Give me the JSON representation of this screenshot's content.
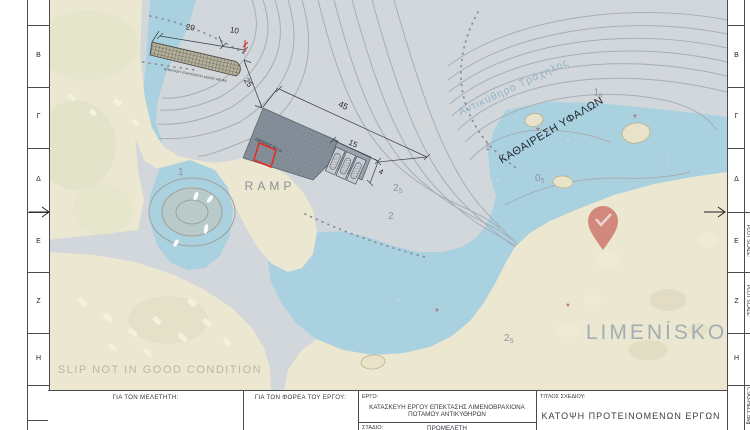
{
  "colors": {
    "sea": "#d2d7dc",
    "shallow_water": "#a9d1e0",
    "land": "#ebe7d0",
    "contour": "#a8aeb5",
    "structure_fill": "#858f99",
    "accent_red": "#d03028",
    "pin_red": "#c03a38",
    "place_label_blue": "#8fb4c4",
    "faded_label_gray": "#98a5b5"
  },
  "border": {
    "row_letters": [
      "B",
      "Γ",
      "Δ",
      "E",
      "Z",
      "H"
    ],
    "plot_scale_label": "PLOT SCALE:",
    "file_label": "C:\\A3-HELL.dwg"
  },
  "title_block": {
    "designer_label": "ΓΙΑ ΤΟΝ ΜΕΛΕΤΗΤΗ:",
    "agency_label": "ΓΙΑ ΤΟΝ ΦΟΡΕΑ ΤΟΥ ΕΡΓΟΥ:",
    "project_label": "ΕΡΓΟ:",
    "project_title": "ΚΑΤΑΣΚΕΥΗ ΕΡΓΟΥ ΕΠΕΚΤΑΣΗΣ ΛΙΜΕΝΟΒΡΑΧΙΟΝΑ ΠΟΤΑΜΟΥ ΑΝΤΙΚΥΘΗΡΩΝ",
    "stage_label": "ΣΤΑΔΙΟ:",
    "stage_value": "ΠΡΟΜΕΛΕΤΗ",
    "sheet_title_label": "ΤΙΤΛΟΣ ΣΧΕΔΙΟΥ:",
    "sheet_title": "ΚΑΤΟΨΗ ΠΡΟΤΕΙΝΟΜΕΝΩΝ ΕΡΓΩΝ"
  },
  "map": {
    "labels": {
      "place_name": "Αντικύθηρο Τράχηλος",
      "reef_removal": "ΚΑΘΑΙΡΕΣΗ ΥΦΑΛΩΝ",
      "limeniskos": "LIMENÍSKOS",
      "slip_note": "SLIP NOT IN GOOD CONDITION",
      "ramp": "RAMP",
      "mole_caption": "ΕΠΕΚΤΑΣΗ ΥΠΑΡΧΟΝΤΟΣ ΜΩΛΟΥ ΜΕ Φ/Σ",
      "building_caption": "ΟΙΚΙΣΚΟΣ 50 τ.μ."
    },
    "dimensions": {
      "d20": "20",
      "d10": "10",
      "d25": "25",
      "d45": "45",
      "d15": "15",
      "d4": "4"
    },
    "depths": [
      {
        "whole": "1",
        "frac": "5"
      },
      {
        "whole": "1",
        "frac": ""
      },
      {
        "whole": "0",
        "frac": "5"
      },
      {
        "whole": "2",
        "frac": "5"
      },
      {
        "whole": "2",
        "frac": ""
      },
      {
        "whole": "1",
        "frac": ""
      },
      {
        "whole": "2",
        "frac": "5"
      }
    ],
    "rock_symbol": "*"
  }
}
